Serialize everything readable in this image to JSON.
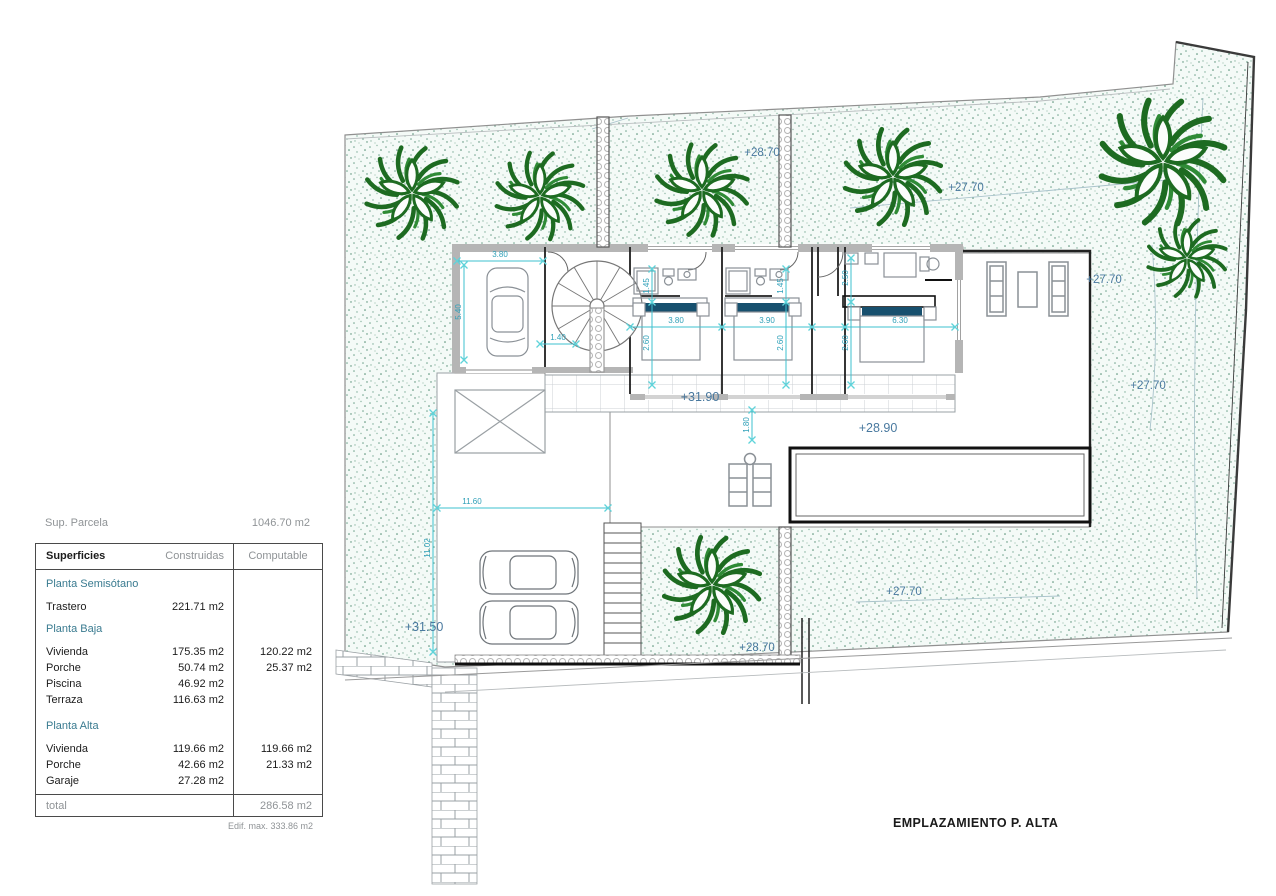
{
  "labels": {
    "sup_parcela": "Sup. Parcela",
    "sup_parcela_value": "1046.70 m2",
    "note": "Edif. max. 333.86 m2",
    "title": "EMPLAZAMIENTO P. ALTA"
  },
  "table": {
    "col_superficies": "Superficies",
    "col_construidas": "Construidas",
    "col_computable": "Computable",
    "rows": [
      {
        "kind": "section",
        "label": "Planta Semisótano",
        "construida": "",
        "computable": ""
      },
      {
        "kind": "row",
        "label": "Trastero",
        "construida": "221.71 m2",
        "computable": ""
      },
      {
        "kind": "section",
        "label": "Planta Baja",
        "construida": "",
        "computable": ""
      },
      {
        "kind": "row",
        "label": "Vivienda",
        "construida": "175.35 m2",
        "computable": "120.22 m2"
      },
      {
        "kind": "row",
        "label": "Porche",
        "construida": "50.74 m2",
        "computable": "25.37 m2"
      },
      {
        "kind": "row",
        "label": "Piscina",
        "construida": "46.92 m2",
        "computable": ""
      },
      {
        "kind": "row",
        "label": "Terraza",
        "construida": "116.63 m2",
        "computable": ""
      },
      {
        "kind": "section",
        "label": "Planta Alta",
        "construida": "",
        "computable": ""
      },
      {
        "kind": "row",
        "label": "Vivienda",
        "construida": "119.66 m2",
        "computable": "119.66 m2"
      },
      {
        "kind": "row",
        "label": "Porche",
        "construida": "42.66 m2",
        "computable": "21.33 m2"
      },
      {
        "kind": "row",
        "label": "Garaje",
        "construida": "27.28 m2",
        "computable": ""
      }
    ],
    "total_label": "total",
    "total_value": "286.58 m2"
  },
  "elevations": {
    "top_left": "+28.70",
    "top_mid": "+27.70",
    "right_upper": "+27.70",
    "right_lower": "+27.70",
    "deck": "+31.90",
    "terrace": "+28.90",
    "driveway": "+31.50",
    "bottom_left": "+28.70",
    "bottom_mid": "+27.70"
  },
  "dimensions": {
    "garage_w": "3.80",
    "garage_d": "5.40",
    "stair_gap": "1.40",
    "bed1_w": "3.80",
    "bed2_w": "3.90",
    "master_w": "6.30",
    "bed1_d": "2.60",
    "bed2_d": "2.60",
    "master_d": "2.60",
    "bath1_d": "1.45",
    "bath2_d": "1.45",
    "master_top": "2.50",
    "deck_d": "1.80",
    "drive_w": "11.60",
    "drive_d": "11.02"
  },
  "colors": {
    "elevation_text": "#49799f",
    "dimension": "#3ec1cf",
    "section_text": "#3a7b90",
    "plant_green": "#1d6b21",
    "headboard": "#17506e"
  }
}
